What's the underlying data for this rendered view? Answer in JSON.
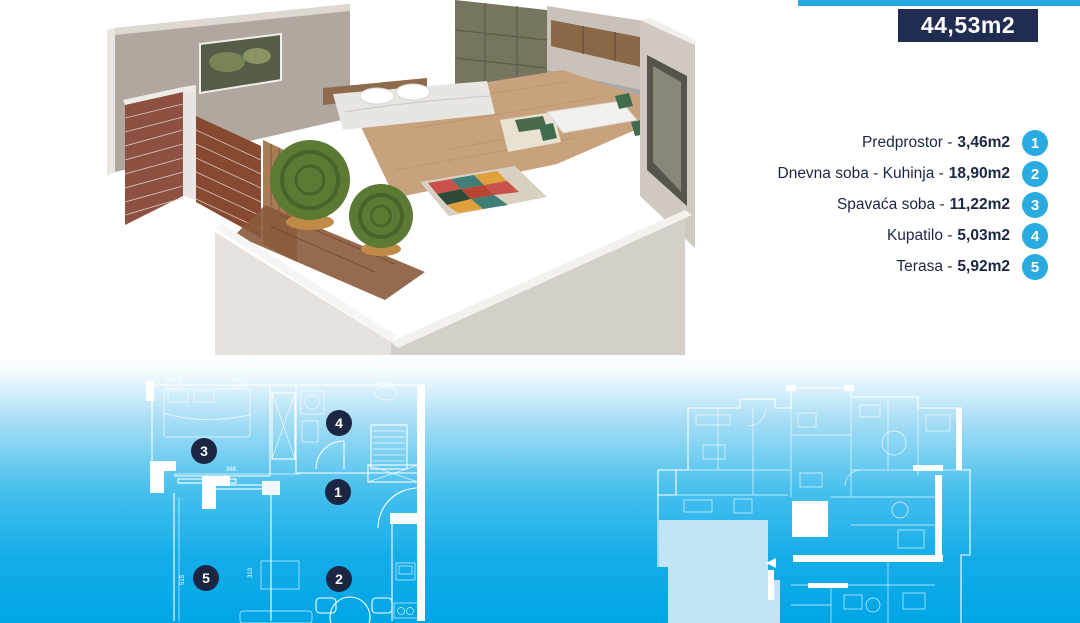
{
  "header": {
    "area_value": "44,53m2",
    "colors": {
      "accent_cyan": "#29abe2",
      "badge_navy": "#212c52",
      "marker_navy": "#1b2742",
      "list_text": "#1b2742",
      "plan_lines": "#ffffff",
      "highlighted_unit": "#c3e4f4",
      "band_bottom": "#00a5e6"
    }
  },
  "rooms": [
    {
      "num": "1",
      "name": "Predprostor -",
      "area": "3,46m2"
    },
    {
      "num": "2",
      "name": "Dnevna soba - Kuhinja -",
      "area": "18,90m2"
    },
    {
      "num": "3",
      "name": "Spavaća soba -",
      "area": "11,22m2"
    },
    {
      "num": "4",
      "name": "Kupatilo -",
      "area": "5,03m2"
    },
    {
      "num": "5",
      "name": "Terasa -",
      "area": "5,92m2"
    }
  ],
  "plan": {
    "dimensions": {
      "d1": "368",
      "d2": "313",
      "d3": "515"
    }
  }
}
